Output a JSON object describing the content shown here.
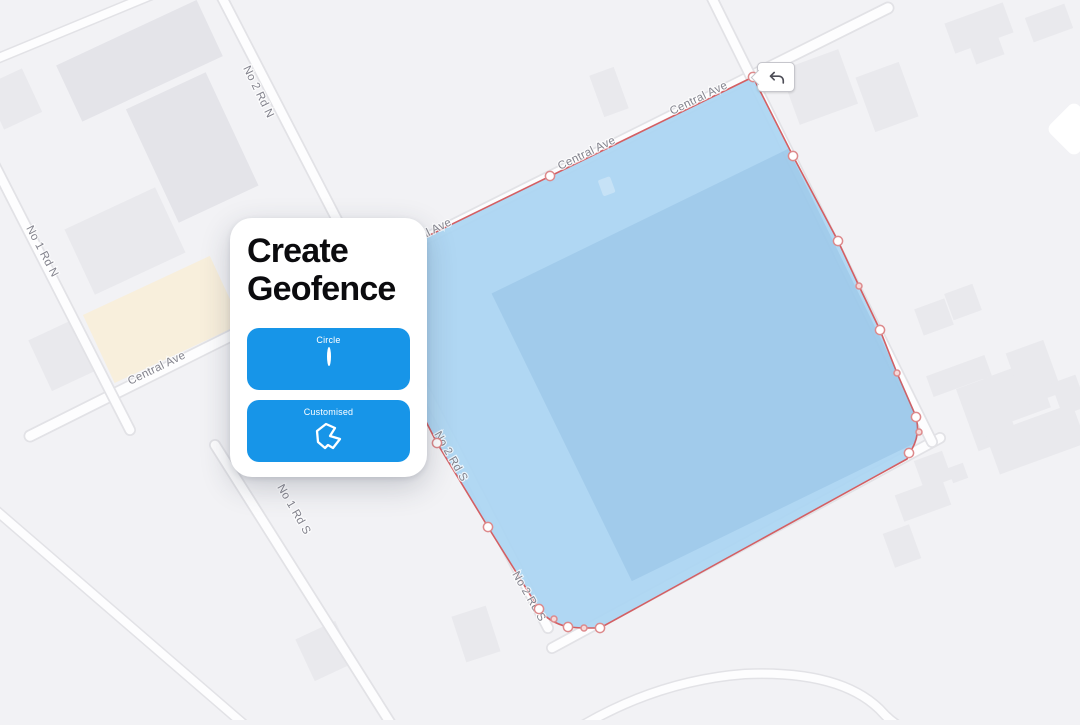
{
  "colors": {
    "accent": "#1795e8",
    "geofence_fill": "#abd5f2",
    "geofence_stroke": "#d45f63",
    "map_background": "#f2f2f5"
  },
  "popup": {
    "title_line1": "Create",
    "title_line2": "Geofence",
    "buttons": [
      {
        "label": "Circle",
        "icon": "circle-outline-icon"
      },
      {
        "label": "Customised",
        "icon": "custom-polygon-icon"
      }
    ]
  },
  "map": {
    "undo_icon": "undo-arrow-icon",
    "street_labels": [
      {
        "text": "No 2 Rd N"
      },
      {
        "text": "No 1 Rd N"
      },
      {
        "text": "Central Ave"
      },
      {
        "text": "Central Ave"
      },
      {
        "text": "Central Ave"
      },
      {
        "text": "Central Ave"
      },
      {
        "text": "No 1 Rd S"
      },
      {
        "text": "No 2 Rd S"
      },
      {
        "text": "No 2 Rd S"
      }
    ]
  }
}
